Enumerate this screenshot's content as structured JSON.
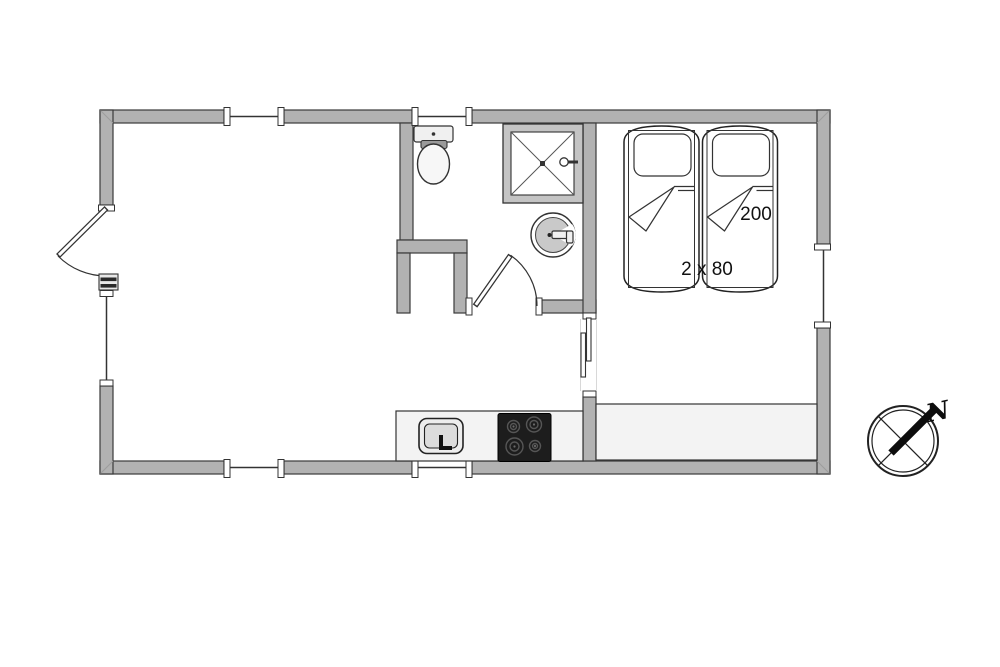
{
  "diagram": {
    "type": "floor-plan",
    "labels": {
      "bed_length": "200",
      "bed_width": "2 x 80",
      "compass_north": "N"
    },
    "colors": {
      "wall_fill": "#b2b2b2",
      "wall_stroke": "#3a3a3a",
      "floor": "#ffffff",
      "counter_fill": "#f3f3f3",
      "stove_fill": "#1d1d1d",
      "fixture_gray": "#c9c9c9",
      "line": "#333333"
    },
    "windows_count": 6,
    "doors": [
      "entrance-door",
      "bathroom-door",
      "sliding-door"
    ],
    "fixtures": [
      "toilet",
      "shower",
      "washbasin",
      "kitchen-counter",
      "kitchen-sink",
      "cooktop",
      "twin-bed-left",
      "twin-bed-right",
      "bedroom-counter",
      "compass-rose"
    ]
  }
}
